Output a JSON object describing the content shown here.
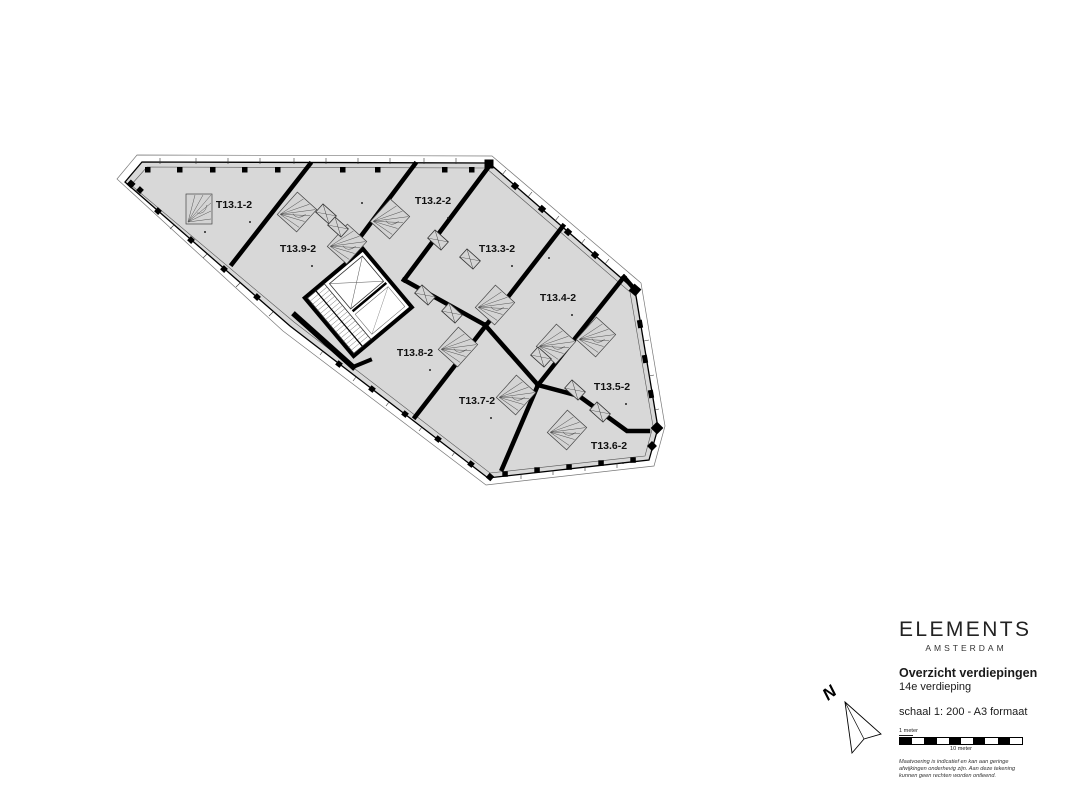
{
  "plan": {
    "fill_color": "#d8d8d8",
    "line_color": "#000000",
    "units": [
      {
        "label": "T13.1-2"
      },
      {
        "label": "T13.2-2"
      },
      {
        "label": "T13.3-2"
      },
      {
        "label": "T13.4-2"
      },
      {
        "label": "T13.5-2"
      },
      {
        "label": "T13.6-2"
      },
      {
        "label": "T13.7-2"
      },
      {
        "label": "T13.8-2"
      },
      {
        "label": "T13.9-2"
      }
    ]
  },
  "north_arrow": {
    "label": "N"
  },
  "title_block": {
    "brand": "ELEMENTS",
    "brand_sub": "AMSTERDAM",
    "title": "Overzicht verdiepingen",
    "subtitle": "14e verdieping",
    "scale_text": "schaal 1: 200 - A3 formaat",
    "scale_bar": {
      "start_label": "1 meter",
      "end_label": "10 meter"
    },
    "disclaimer_lines": [
      "Maatvoering is indicatief en kan aan geringe",
      "afwijkingen onderhevig zijn. Aan deze tekening",
      "kunnen geen rechten worden ontleend."
    ]
  }
}
